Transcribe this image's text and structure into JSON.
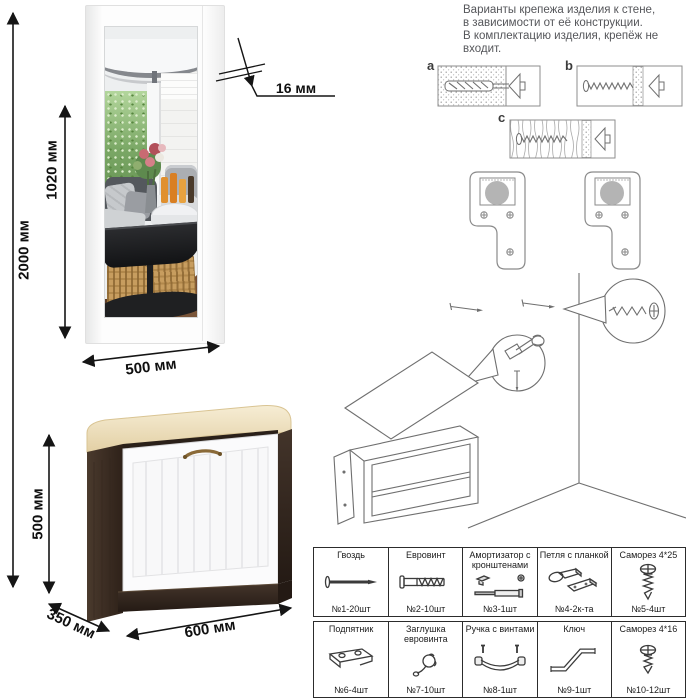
{
  "instructions": {
    "lines": [
      "Варианты крепежа изделия к стене,",
      "в зависимости от её конструкции.",
      "В комплектацию изделия, крепёж не",
      "входит."
    ]
  },
  "dimensions": {
    "total_height": "2000 мм",
    "mirror_height": "1020 мм",
    "mirror_width": "500 мм",
    "mirror_thickness": "16 мм",
    "bench_height": "500 мм",
    "bench_depth": "350 мм",
    "bench_width": "600 мм"
  },
  "fastener_variants": {
    "a": "a",
    "b": "b",
    "c": "c"
  },
  "hardware_table": {
    "rows": [
      [
        {
          "name": "Гвоздь",
          "qty": "№1-20шт",
          "icon": "nail-icon"
        },
        {
          "name": "Евровинт",
          "qty": "№2-10шт",
          "icon": "euroscrew-icon"
        },
        {
          "name": "Амортизатор с кронштенами",
          "qty": "№3-1шт",
          "icon": "gas-lift-icon"
        },
        {
          "name": "Петля с планкой",
          "qty": "№4-2к-та",
          "icon": "hinge-icon"
        },
        {
          "name": "Саморез 4*25",
          "qty": "№5-4шт",
          "icon": "screw-icon"
        }
      ],
      [
        {
          "name": "Подпятник",
          "qty": "№6-4шт",
          "icon": "glide-icon"
        },
        {
          "name": "Заглушка евровинта",
          "qty": "№7-10шт",
          "icon": "cap-icon"
        },
        {
          "name": "Ручка с винтами",
          "qty": "№8-1шт",
          "icon": "handle-icon"
        },
        {
          "name": "Ключ",
          "qty": "№9-1шт",
          "icon": "key-icon"
        },
        {
          "name": "Саморез 4*16",
          "qty": "№10-12шт",
          "icon": "screw-icon"
        }
      ]
    ]
  },
  "colors": {
    "wenge": "#3b2d24",
    "cushion_cream": "#efe2c0",
    "door_white": "#fbfbfc",
    "dimension_line": "#151515",
    "instruction_text": "#55565a"
  }
}
